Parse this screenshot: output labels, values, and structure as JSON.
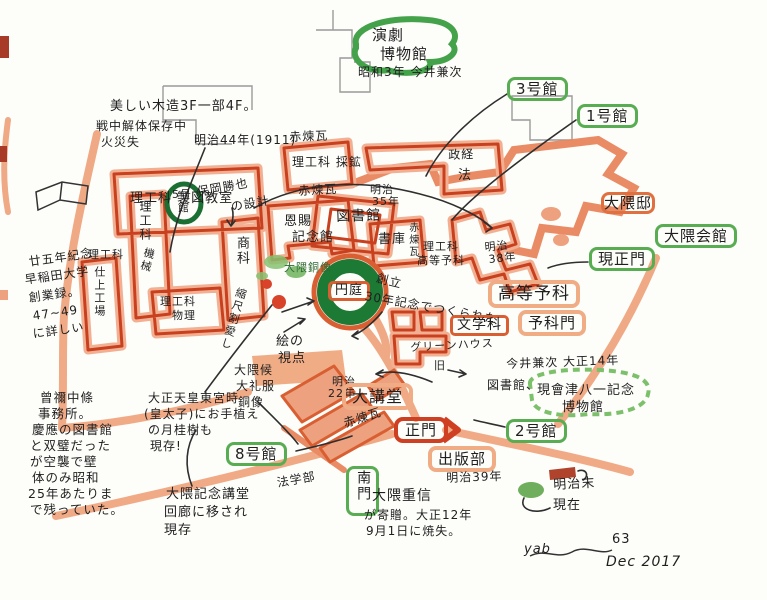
{
  "legend": {
    "meiji_label": "明治末",
    "present_label": "現在",
    "meiji_color": "#b0432c",
    "present_color": "#6fae5c"
  },
  "signature": {
    "initials": "yab",
    "number": "63",
    "date": "Dec 2017"
  },
  "bubbles": {
    "engeki": [
      "演劇",
      "博物館"
    ],
    "engeki_note": "昭和3年 今井兼次",
    "bldg3": "3号館",
    "bldg1": "1号館",
    "bldg5": [
      "5号",
      "館"
    ],
    "bldg2": "2号館",
    "bldg8": "8号館",
    "okuma_tei": "大隈邸",
    "okuma_kaikan": "大隈会館",
    "gen_seimon": "現正門",
    "aizu": [
      "現會津八一記念",
      "博物館"
    ],
    "nanmon": "南門"
  },
  "buildings": {
    "seizu": "理工科 製図教室",
    "saiko": "理工科 採鉱",
    "kikai": [
      "理工科",
      "機械"
    ],
    "rika_left": "理工科",
    "shiage": "仕上工場",
    "shoka": "商科",
    "rika_bottom": [
      "理工科",
      "物理"
    ],
    "onshi": [
      "恩賜",
      "記念館"
    ],
    "toshokan": "図書館",
    "shoko": "書庫",
    "seikei": "政経",
    "ho": "法",
    "rikoka_koto": [
      "理工科",
      "高等予科"
    ],
    "koto_yoka": "高等予科",
    "yokamon": "予科門",
    "bungakuka": "文学科",
    "greenhouse": "グリーンハウス",
    "kyu": "旧",
    "daikodo": "大講堂",
    "seimon": "正門",
    "shuppanbu": "出版部",
    "entei": "円庭",
    "hogakubu": "法学部"
  },
  "notes": {
    "utsukushii": "美しい木造3F一部4F。",
    "senchu": [
      "戦中解体保存中",
      "火災失"
    ],
    "meiji44": "明治44年(1911)",
    "akarenga": "赤煉瓦",
    "hooka": [
      "保岡勝也",
      "の設計"
    ],
    "meiji35": [
      "明治",
      "35年"
    ],
    "meiji38": [
      "明治",
      "38年"
    ],
    "meiji22": [
      "明治",
      "22年"
    ],
    "meiji39": "明治39年",
    "okuma_dozo": "大隈銅像",
    "soritsu": [
      "創立",
      "30年記念でつくられた"
    ],
    "shiten": [
      "絵の",
      "視点"
    ],
    "shukushaku": "縮尺割愛し",
    "book": [
      "廿五年紀念",
      "早稲田大学",
      "創業録。",
      "47~49",
      "に詳しい"
    ],
    "sone": [
      "曾禰中條",
      "事務所。",
      "慶應の図書館",
      "と双璧だった",
      "が空襲で壁",
      "体のみ昭和",
      "25年あたりま",
      "で残っていた。"
    ],
    "laurel": [
      "大正天皇東宮時",
      "(皇太子)にお手植え",
      "の月桂樹も",
      "現存!"
    ],
    "tairei": [
      "大隈候",
      "大礼服",
      "銅像"
    ],
    "imai": [
      "今井兼次 大正14年",
      "図書館、"
    ],
    "kodo_kairo": [
      "大隈記念講堂",
      "回廊に移され",
      "現存"
    ],
    "shigenobu": [
      "大隈重信",
      "が寄贈。大正12年",
      "9月1日に焼失。"
    ]
  }
}
